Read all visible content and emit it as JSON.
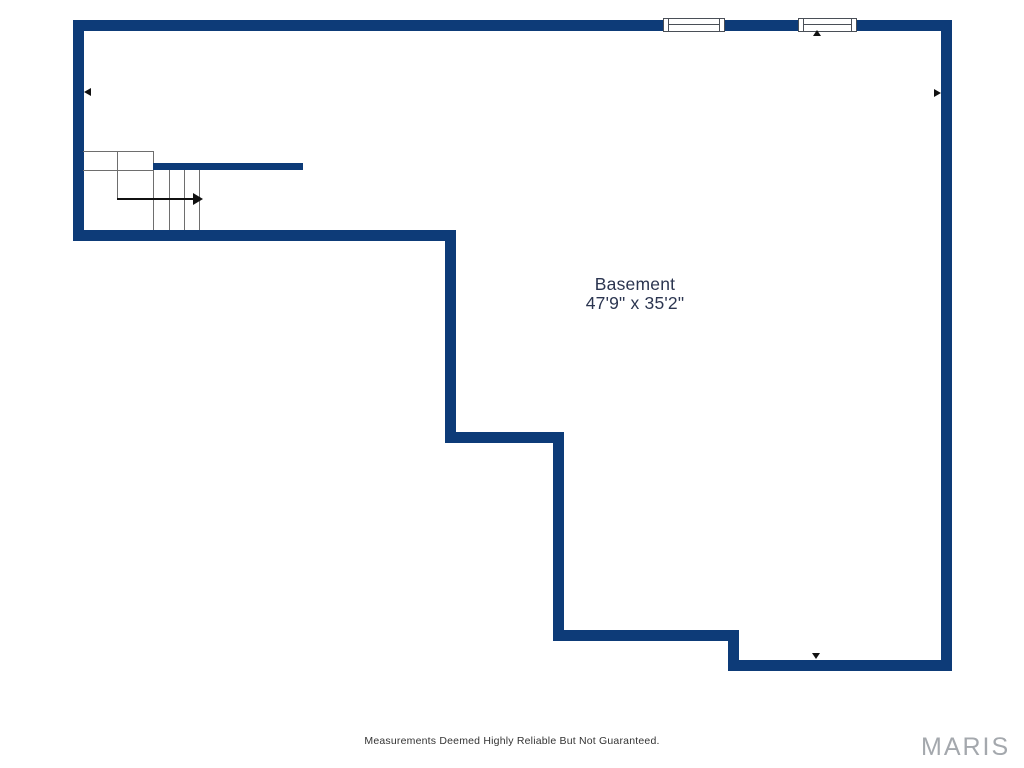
{
  "floorplan": {
    "room": {
      "name": "Basement",
      "dimensions": "47'9\" x 35'2\""
    },
    "features": {
      "windows": [
        {
          "name": "window-top-1",
          "wall": "top"
        },
        {
          "name": "window-top-2",
          "wall": "top"
        }
      ],
      "stairs": {
        "location": "upper-left",
        "direction_arrow": "right",
        "treads": 4
      },
      "markers": [
        "left-wall-marker",
        "right-wall-marker",
        "top-wall-marker",
        "bottom-wall-marker"
      ]
    },
    "colors": {
      "wall": "#0d3b78",
      "stair_line": "#6e6e6e",
      "marker": "#111111",
      "room_label": "#2b3550",
      "disclaimer_text": "#333333",
      "watermark_text": "#a4a8ad"
    }
  },
  "footer": {
    "disclaimer": "Measurements Deemed Highly Reliable But Not Guaranteed.",
    "watermark": "MARIS"
  }
}
